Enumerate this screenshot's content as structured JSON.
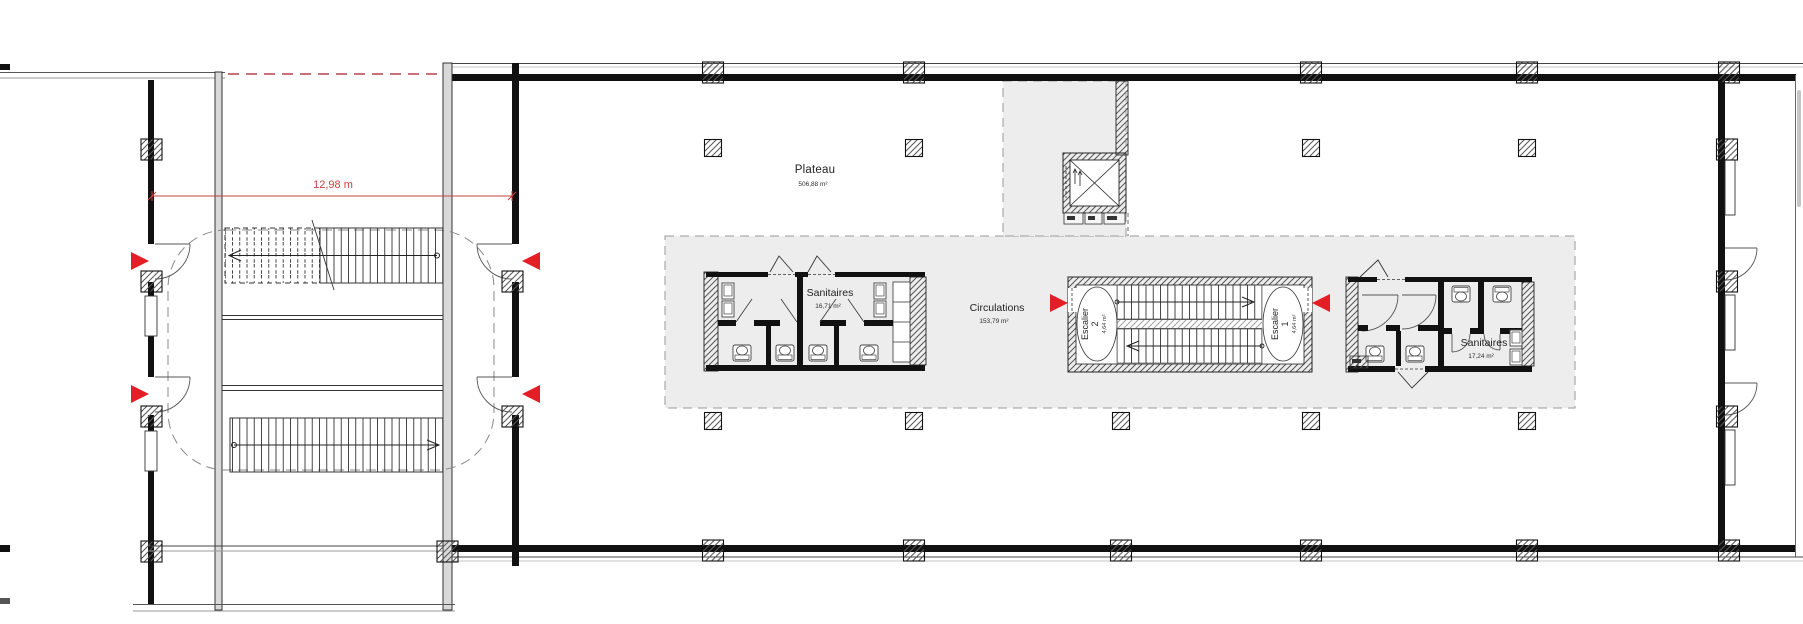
{
  "plan": {
    "rooms": {
      "plateau": {
        "name": "Plateau",
        "area": "506,88 m²"
      },
      "sanitaires_west": {
        "name": "Sanitaires",
        "area": "16,71 m²"
      },
      "circulations": {
        "name": "Circulations",
        "area": "153,79 m²"
      },
      "escalier_2": {
        "name": "Escalier 2",
        "area": "4,64 m²"
      },
      "escalier_1": {
        "name": "Escalier 1",
        "area": "4,64 m²"
      },
      "sanitaires_east": {
        "name": "Sanitaires",
        "area": "17,24 m²"
      }
    },
    "dimension": {
      "label": "12,98 m"
    },
    "colors": {
      "marker_red": "#e31e24",
      "dimension_red": "#c94040",
      "core_fill": "#ededed",
      "line": "#1c1c1c"
    }
  }
}
